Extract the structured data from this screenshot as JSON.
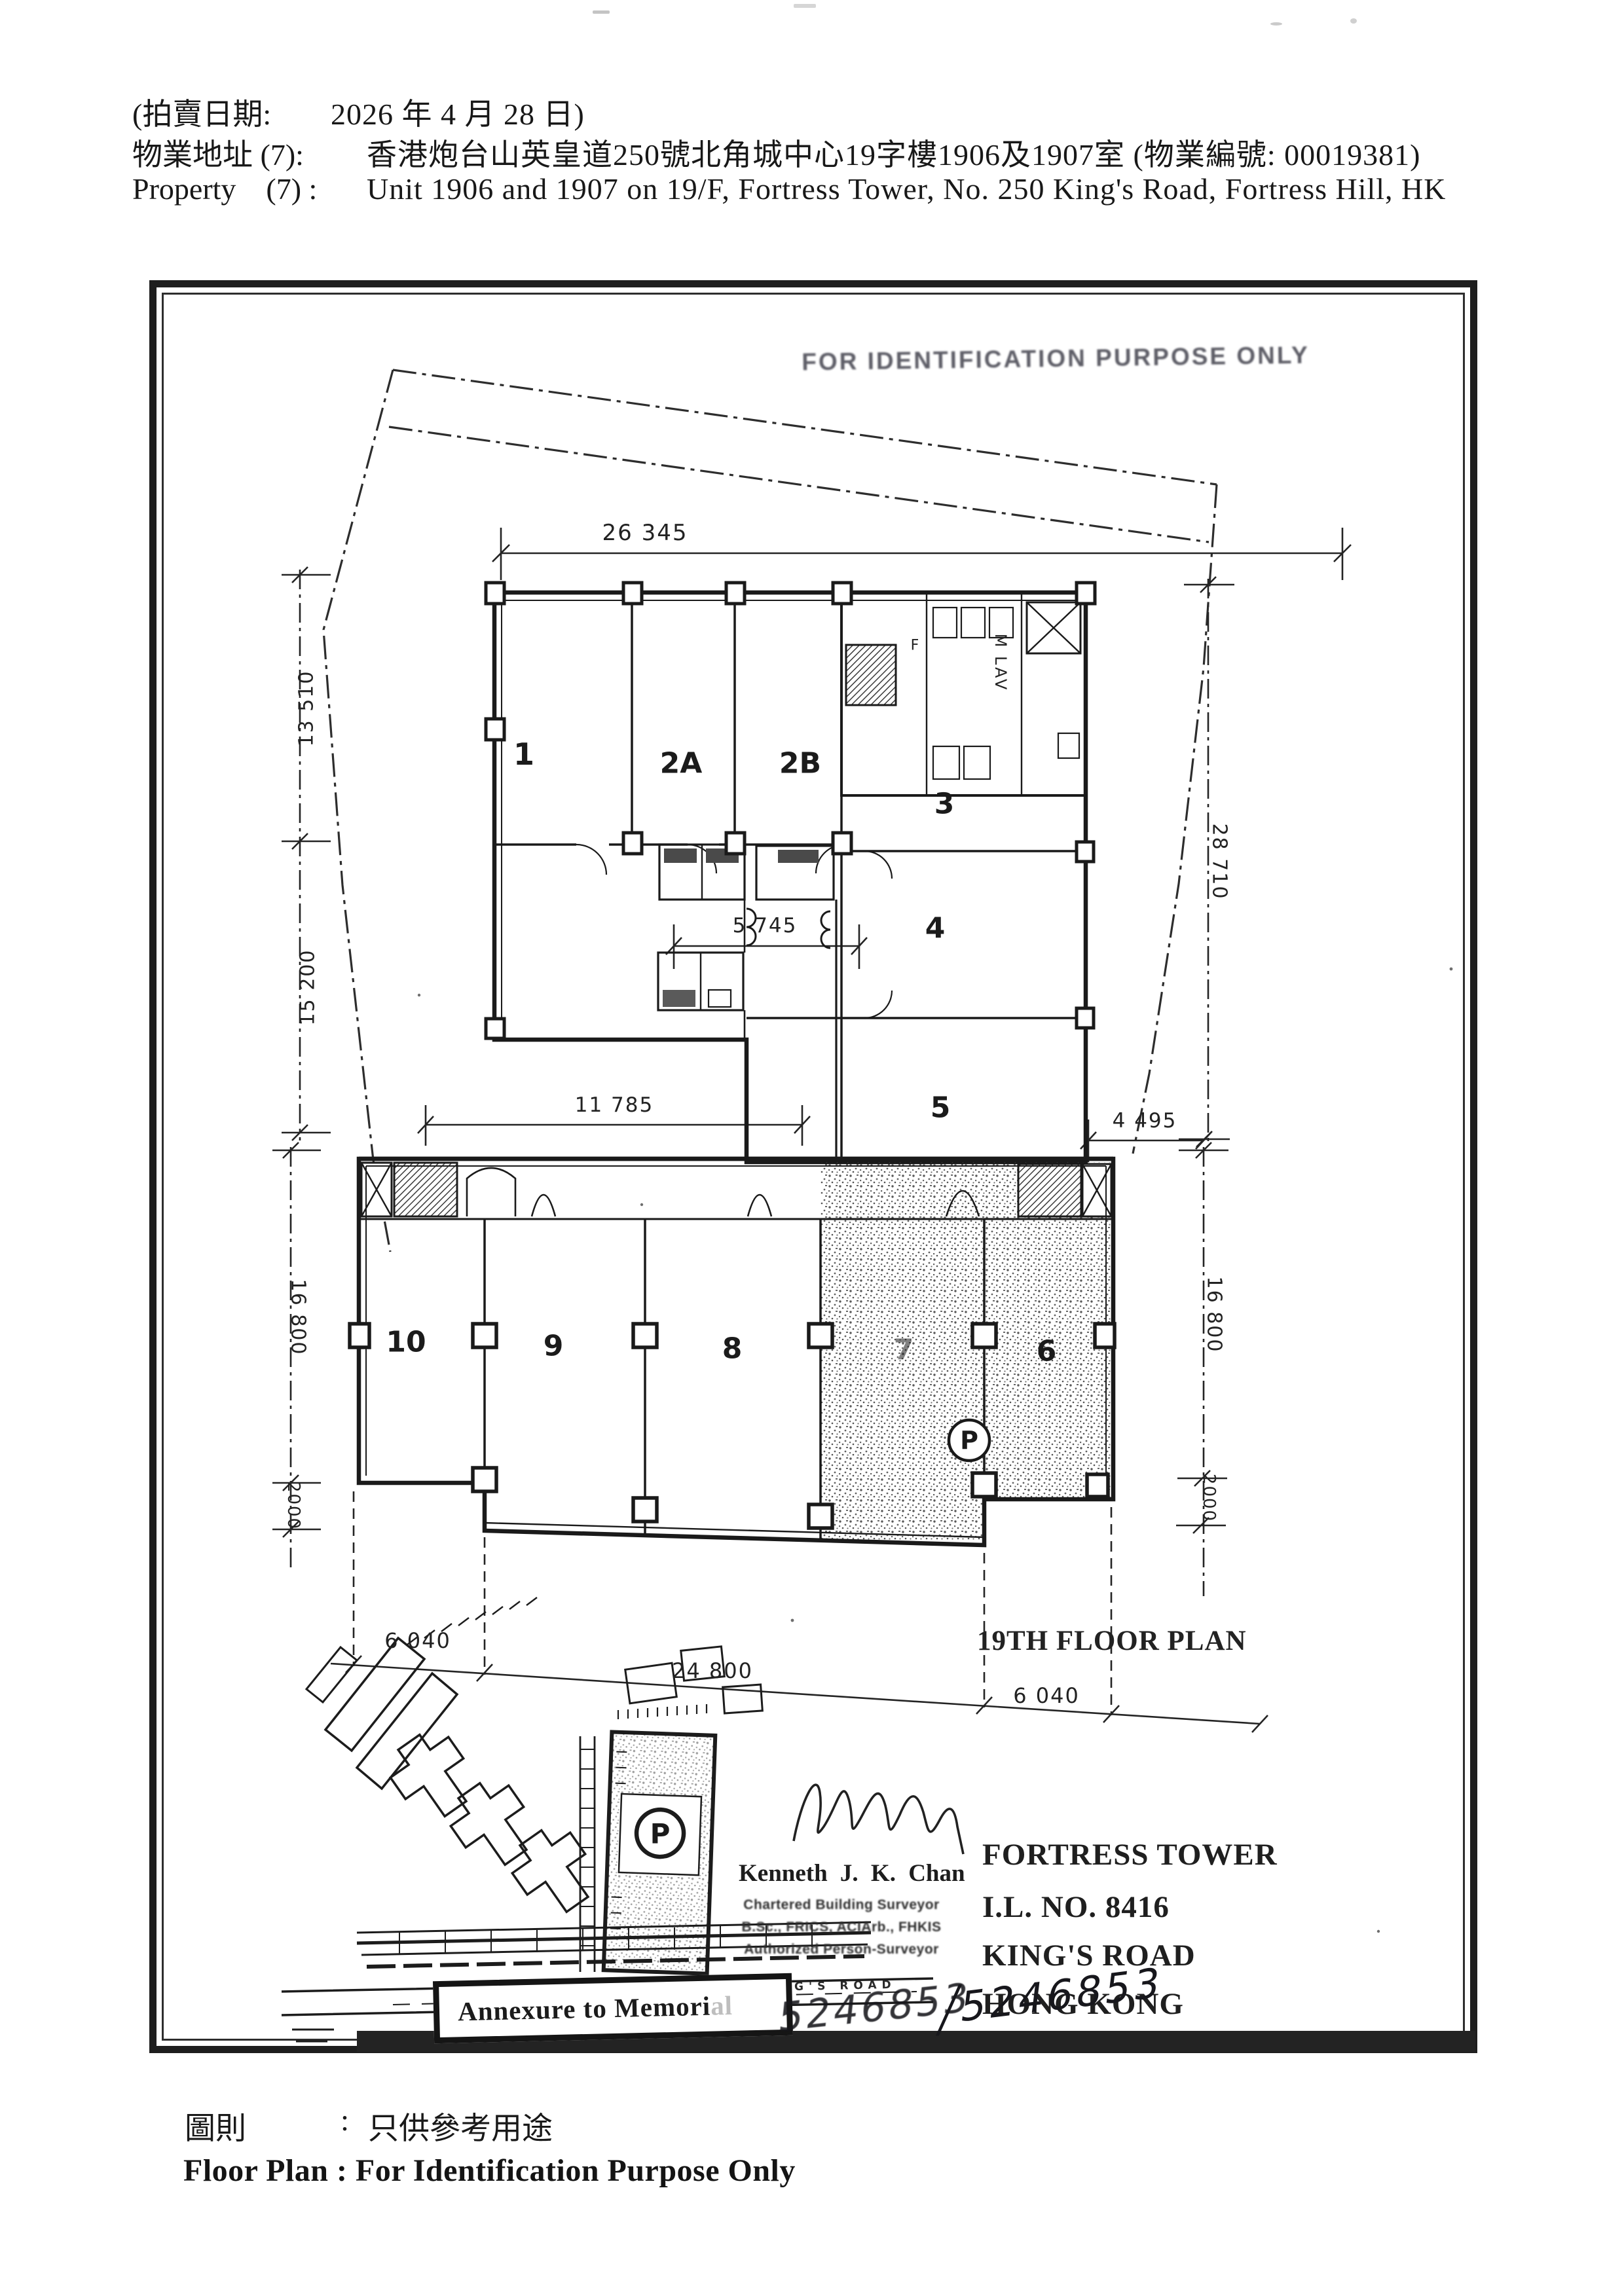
{
  "header": {
    "line1_label": "(拍賣日期:",
    "line1_value": "2026 年 4 月 28 日)",
    "line2_label": "物業地址 (7):",
    "line2_value": "香港炮台山英皇道250號北角城中心19字樓1906及1907室 (物業編號: 00019381)",
    "line3_label": "Property    (7) :",
    "line3_value": "Unit 1906 and 1907 on 19/F, Fortress Tower, No. 250 King's Road, Fortress Hill, HK"
  },
  "plan": {
    "stamp": "FOR IDENTIFICATION PURPOSE ONLY",
    "title": "19TH FLOOR PLAN",
    "dims": {
      "top": "26 345",
      "left_upper": "13 510",
      "left_mid": "15 200",
      "left_lower": "16 800",
      "left_step": "2000",
      "mid_a": "5 745",
      "mid_b": "11 785",
      "mid_c": "4 495",
      "right_upper": "28 710",
      "right_lower": "16 800",
      "right_step": "2000",
      "bottom_left": "6 040",
      "bottom_mid": "24 800",
      "bottom_right": "6 040"
    },
    "units": {
      "u1": "1",
      "u2a": "2A",
      "u2b": "2B",
      "u3": "3",
      "u4": "4",
      "u5": "5",
      "u6": "6",
      "u7": "7",
      "u8": "8",
      "u9": "9",
      "u10": "10"
    },
    "labels": {
      "m_lav": "M LAV",
      "f_lav": "F",
      "parking": "P"
    }
  },
  "titleblock": {
    "building": "FORTRESS TOWER",
    "lot": "I.L. NO. 8416",
    "road": "KING'S ROAD",
    "city": "HONG KONG"
  },
  "surveyor": {
    "name": "Kenneth J. K. Chan",
    "title1": "Chartered Building Surveyor",
    "title2": "B.Sc., FRICS, ACIArb., FHKIS",
    "title3": "Authorized Person-Surveyor"
  },
  "sitemap": {
    "road": "KING'S ROAD",
    "parking": "P"
  },
  "annexure": {
    "box_text": "Annexure to Memori",
    "box_text_faded": "al",
    "number1": "5246853",
    "number2_prefix": "/",
    "number2": "5246853"
  },
  "footer": {
    "zh_label": "圖則",
    "colon": ":",
    "zh_text": "只供參考用途",
    "en": "Floor Plan : For Identification Purpose Only"
  }
}
